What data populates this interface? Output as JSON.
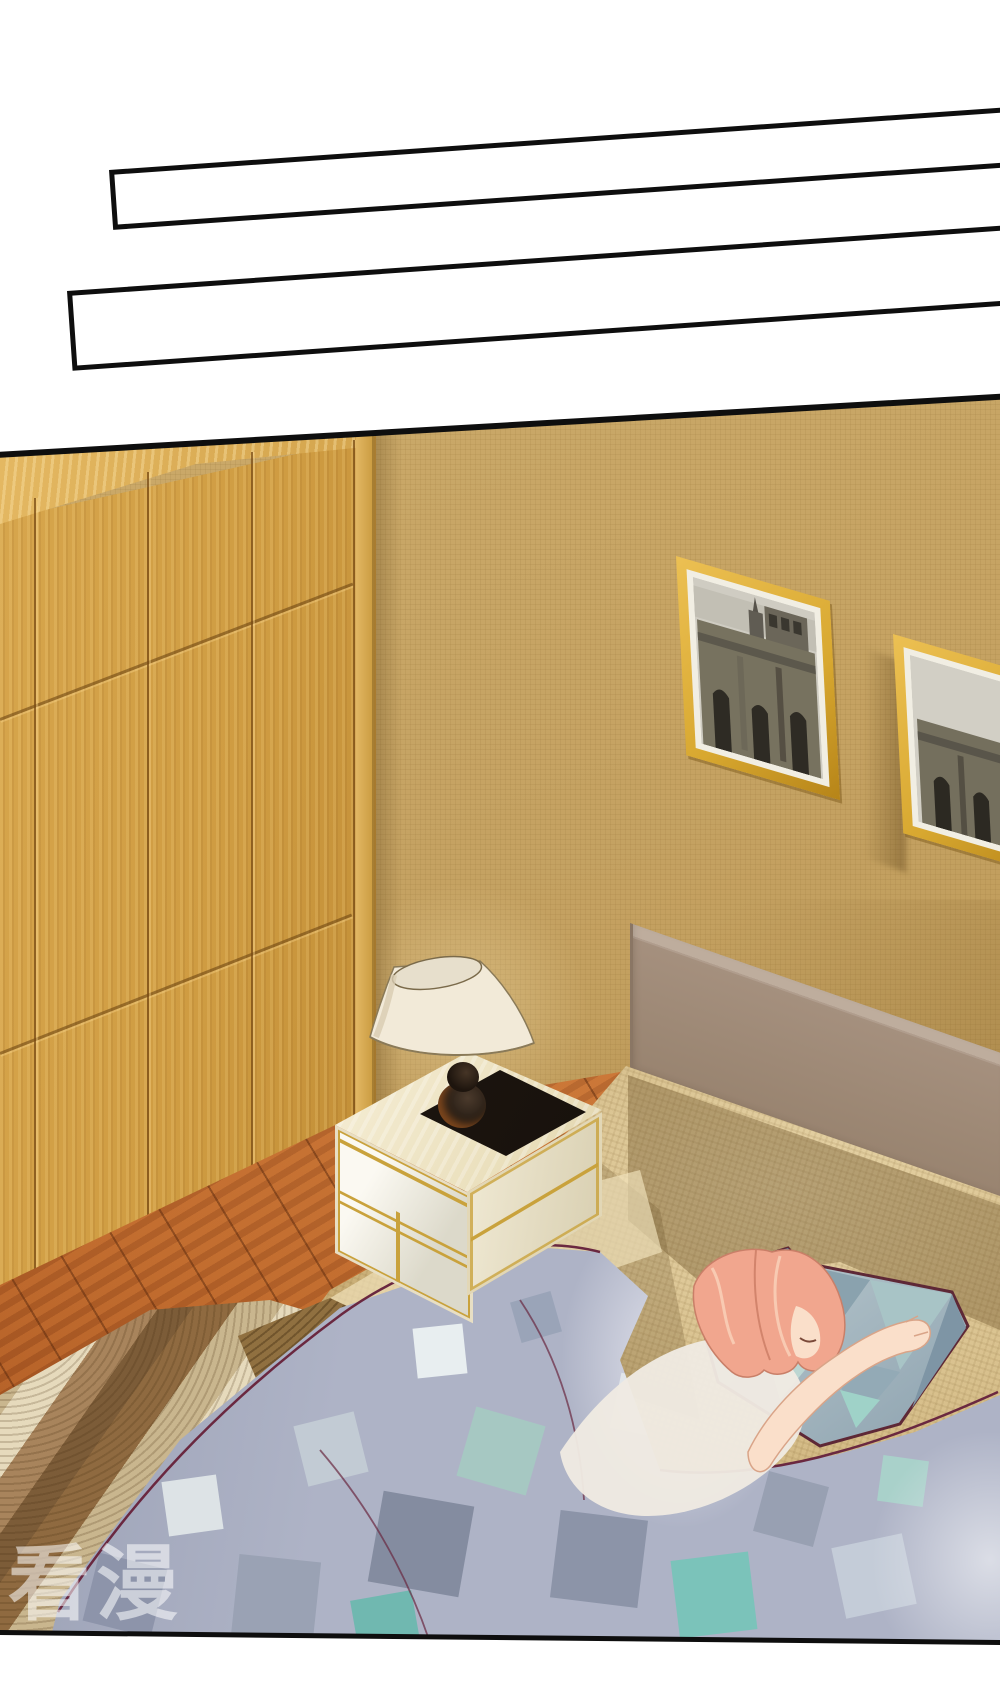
{
  "page": {
    "type": "manga-panel",
    "watermark": "看漫",
    "speech_boxes": [
      {
        "id": 1,
        "text": ""
      },
      {
        "id": 2,
        "text": ""
      }
    ],
    "scene_objects": [
      "wardrobe",
      "wallpaper-wall",
      "two-framed-cathedral-pictures",
      "nightstand-with-lamp",
      "bed-with-headboard",
      "sleeping-woman",
      "geometric-pillow",
      "geometric-blanket",
      "wood-floor",
      "striped-rug"
    ],
    "palette": {
      "panel_border": "#0e0e0e",
      "wall": "#c4a161",
      "wardrobe_wood": "#cf9c42",
      "floor_wood": "#bf6a2d",
      "bed_sheet": "#c6a96f",
      "headboard": "#a5907e",
      "blanket_base": "#aeb3c6",
      "blanket_teal": "#7bc3ba",
      "pillow": "#9db4bd",
      "hair": "#f1a68e",
      "skin": "#fadfca",
      "frame_gold": "#d8a830",
      "lamp_shade": "#f2ead8",
      "outline_red": "#6a2840"
    }
  }
}
